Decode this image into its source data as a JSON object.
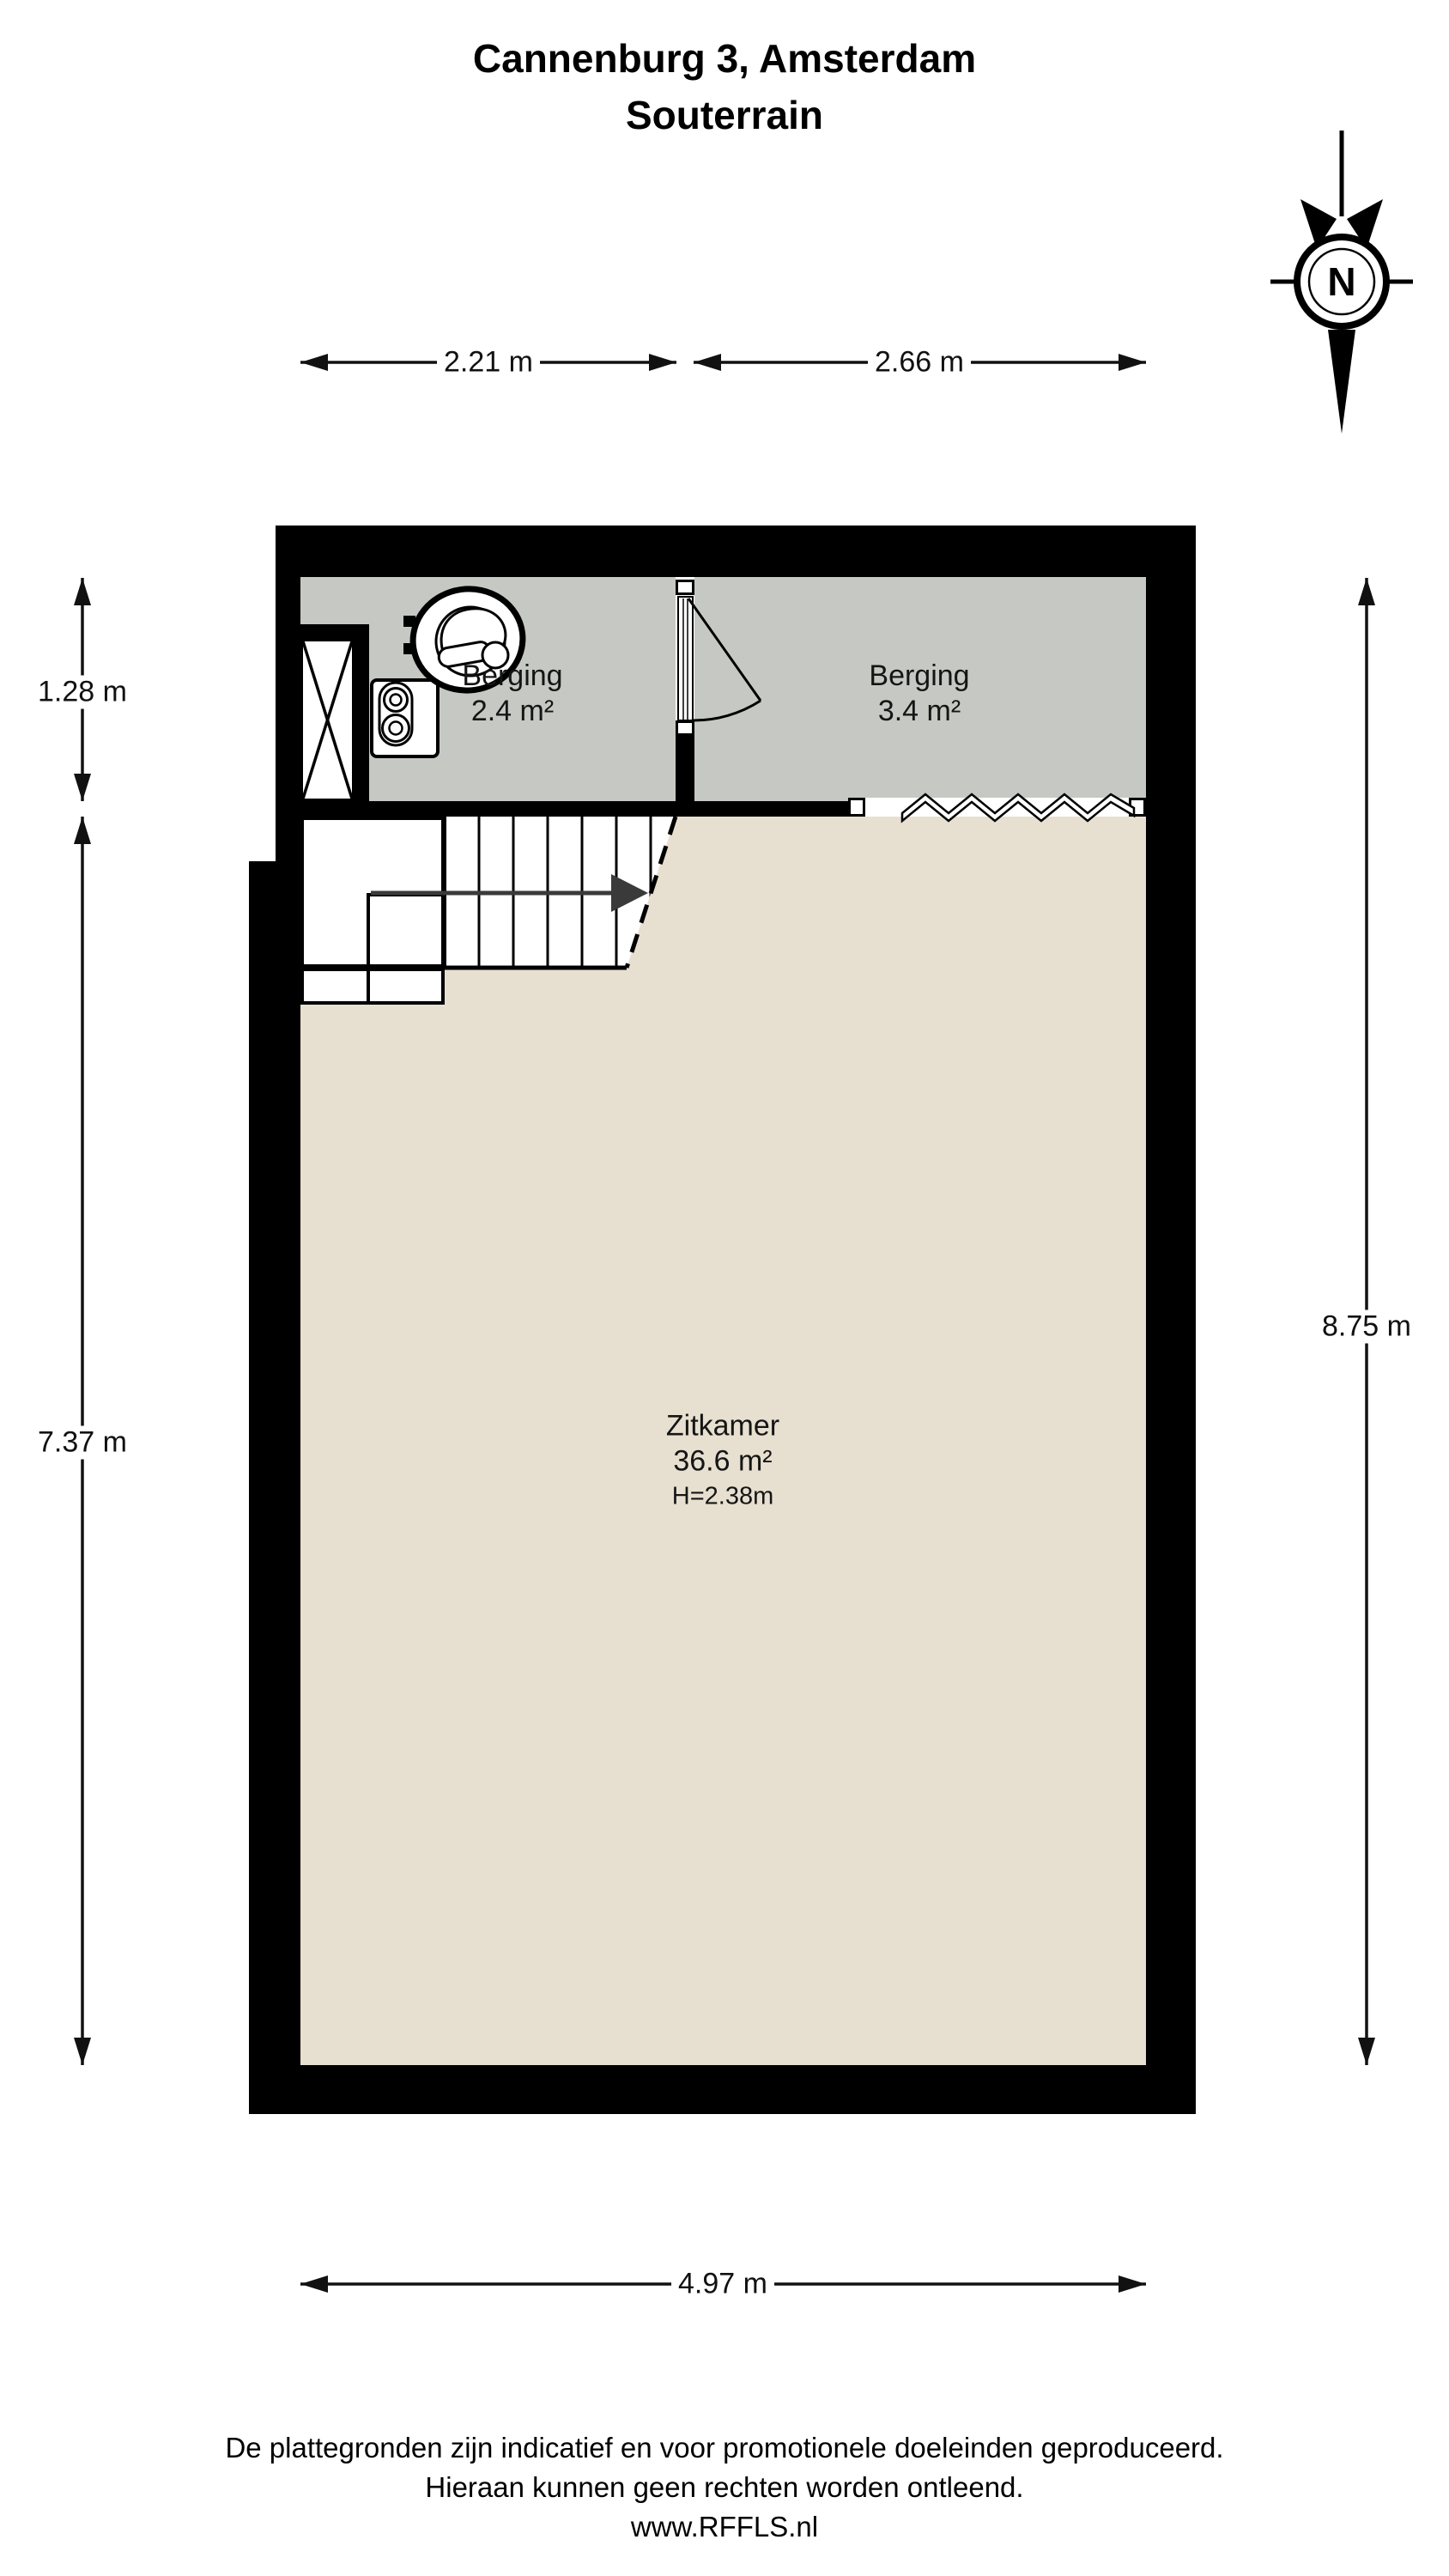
{
  "title": {
    "line1": "Cannenburg 3, Amsterdam",
    "line2": "Souterrain"
  },
  "compass": {
    "label": "N"
  },
  "dimensions": {
    "top_left": "2.21 m",
    "top_right": "2.66 m",
    "left_upper": "1.28 m",
    "left_lower": "7.37 m",
    "right": "8.75 m",
    "bottom": "4.97 m"
  },
  "rooms": {
    "berging_left": {
      "name": "Berging",
      "area": "2.4 m²"
    },
    "berging_right": {
      "name": "Berging",
      "area": "3.4 m²"
    },
    "zitkamer": {
      "name": "Zitkamer",
      "area": "36.6 m²",
      "ceiling_height": "H=2.38m"
    }
  },
  "footer": {
    "line1": "De plattegronden zijn indicatief en voor promotionele doeleinden geproduceerd.",
    "line2": "Hieraan kunnen geen rechten worden ontleend.",
    "line3": "www.RFFLS.nl"
  },
  "colors": {
    "wall": "#000000",
    "storage_floor": "#c6c9c3",
    "living_floor": "#e7dfd0",
    "dimension": "#111111",
    "stairs_arrow": "#3a3a3a"
  }
}
